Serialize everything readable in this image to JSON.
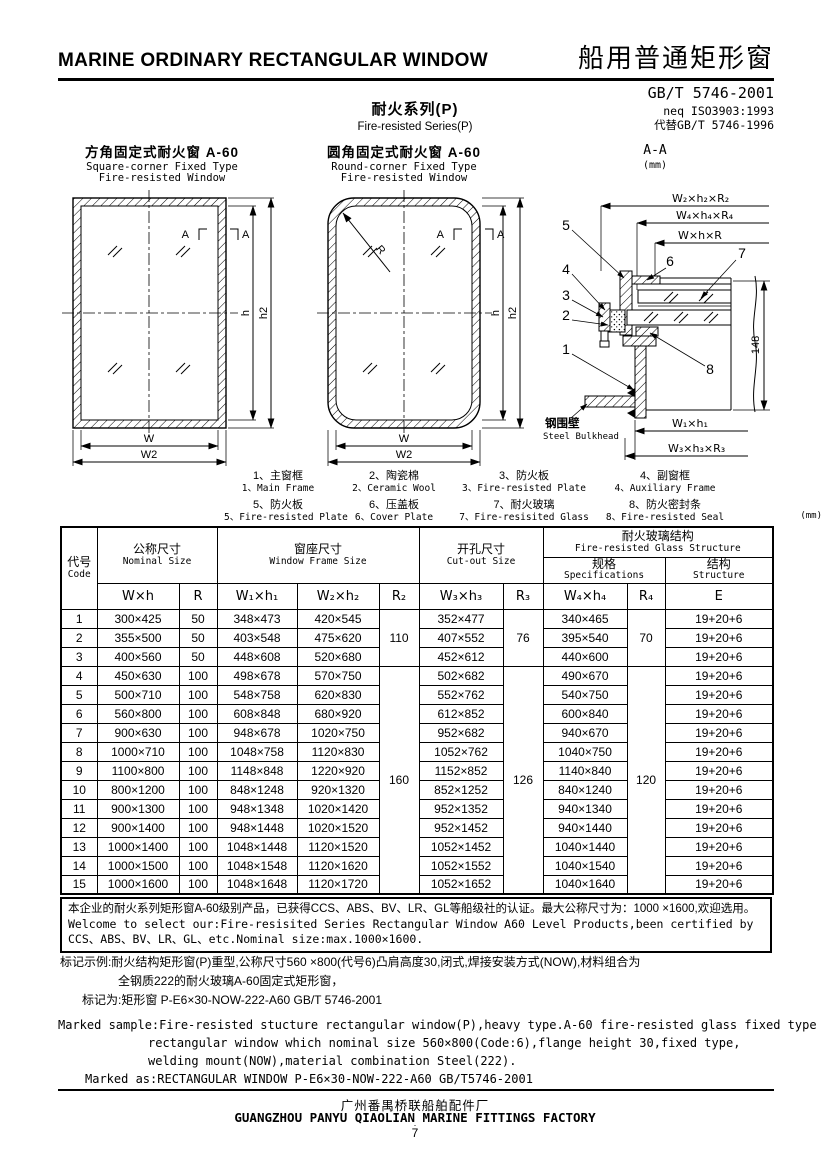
{
  "header": {
    "title_en": "MARINE ORDINARY RECTANGULAR WINDOW",
    "title_cn": "船用普通矩形窗",
    "standard": "GB/T 5746-2001",
    "standard_equiv": "neq ISO3903:1993",
    "standard_replaces": "代替GB/T 5746-1996",
    "series_cn": "耐火系列(P)",
    "series_en": "Fire-resisted Series(P)"
  },
  "diagrams": {
    "square": {
      "title_cn": "方角固定式耐火窗  A-60",
      "title_en1": "Square-corner Fixed Type",
      "title_en2": "Fire-resisted Window",
      "dim_w": "W",
      "dim_w2": "W2",
      "dim_h": "h",
      "dim_h2": "h2",
      "section_letter": "A"
    },
    "round": {
      "title_cn": "圆角固定式耐火窗  A-60",
      "title_en1": "Round-corner Fixed Type",
      "title_en2": "Fire-resisted Window",
      "dim_w": "W",
      "dim_w2": "W2",
      "dim_h": "h",
      "dim_h2": "h2",
      "section_letter": "A",
      "radius_label": "R"
    },
    "section": {
      "title": "A-A",
      "unit": "(mm)",
      "dim_w2h2r2": "W₂×h₂×R₂",
      "dim_w4h4r4": "W₄×h₄×R₄",
      "dim_whr": "W×h×R",
      "dim_w1h1": "W₁×h₁",
      "dim_w3h3r3": "W₃×h₃×R₃",
      "dim_148": "148",
      "bulkhead_cn": "钢围壁",
      "bulkhead_en": "Steel Bulkhead",
      "part_numbers": [
        "1",
        "2",
        "3",
        "4",
        "5",
        "6",
        "7",
        "8"
      ]
    }
  },
  "legend": {
    "items": [
      {
        "cn": "1、主窗框",
        "en": "1、Main Frame"
      },
      {
        "cn": "2、陶瓷棉",
        "en": "2、Ceramic Wool"
      },
      {
        "cn": "3、防火板",
        "en": "3、Fire-resisted Plate"
      },
      {
        "cn": "4、副窗框",
        "en": "4、Auxiliary Frame"
      },
      {
        "cn": "5、防火板",
        "en": "5、Fire-resisted Plate"
      },
      {
        "cn": "6、压盖板",
        "en": "6、Cover Plate"
      },
      {
        "cn": "7、耐火玻璃",
        "en": "7、Fire-resisited Glass"
      },
      {
        "cn": "8、防火密封条",
        "en": "8、Fire-resisted Seal"
      }
    ]
  },
  "table": {
    "unit_note": "(mm)",
    "header": {
      "code_cn": "代号",
      "code_en": "Code",
      "nominal_cn": "公称尺寸",
      "nominal_en": "Nominal Size",
      "frame_cn": "窗座尺寸",
      "frame_en": "Window Frame Size",
      "cutout_cn": "开孔尺寸",
      "cutout_en": "Cut-out Size",
      "glass_cn": "耐火玻璃结构",
      "glass_en": "Fire-resisted Glass Structure",
      "spec_cn": "规格",
      "spec_en": "Specifications",
      "struct_cn": "结构",
      "struct_en": "Structure",
      "col_wh": "W×h",
      "col_r": "R",
      "col_w1h1": "W₁×h₁",
      "col_w2h2": "W₂×h₂",
      "col_r2": "R₂",
      "col_w3h3": "W₃×h₃",
      "col_r3": "R₃",
      "col_w4h4": "W₄×h₄",
      "col_r4": "R₄",
      "col_e": "E"
    },
    "r2_groups": [
      "110",
      "160"
    ],
    "r3_groups": [
      "76",
      "126"
    ],
    "r4_groups": [
      "70",
      "120"
    ],
    "rows": [
      {
        "code": "1",
        "wh": "300×425",
        "r": "50",
        "w1h1": "348×473",
        "w2h2": "420×545",
        "w3h3": "352×477",
        "w4h4": "340×465",
        "e": "19+20+6"
      },
      {
        "code": "2",
        "wh": "355×500",
        "r": "50",
        "w1h1": "403×548",
        "w2h2": "475×620",
        "w3h3": "407×552",
        "w4h4": "395×540",
        "e": "19+20+6"
      },
      {
        "code": "3",
        "wh": "400×560",
        "r": "50",
        "w1h1": "448×608",
        "w2h2": "520×680",
        "w3h3": "452×612",
        "w4h4": "440×600",
        "e": "19+20+6"
      },
      {
        "code": "4",
        "wh": "450×630",
        "r": "100",
        "w1h1": "498×678",
        "w2h2": "570×750",
        "w3h3": "502×682",
        "w4h4": "490×670",
        "e": "19+20+6"
      },
      {
        "code": "5",
        "wh": "500×710",
        "r": "100",
        "w1h1": "548×758",
        "w2h2": "620×830",
        "w3h3": "552×762",
        "w4h4": "540×750",
        "e": "19+20+6"
      },
      {
        "code": "6",
        "wh": "560×800",
        "r": "100",
        "w1h1": "608×848",
        "w2h2": "680×920",
        "w3h3": "612×852",
        "w4h4": "600×840",
        "e": "19+20+6"
      },
      {
        "code": "7",
        "wh": "900×630",
        "r": "100",
        "w1h1": "948×678",
        "w2h2": "1020×750",
        "w3h3": "952×682",
        "w4h4": "940×670",
        "e": "19+20+6"
      },
      {
        "code": "8",
        "wh": "1000×710",
        "r": "100",
        "w1h1": "1048×758",
        "w2h2": "1120×830",
        "w3h3": "1052×762",
        "w4h4": "1040×750",
        "e": "19+20+6"
      },
      {
        "code": "9",
        "wh": "1100×800",
        "r": "100",
        "w1h1": "1148×848",
        "w2h2": "1220×920",
        "w3h3": "1152×852",
        "w4h4": "1140×840",
        "e": "19+20+6"
      },
      {
        "code": "10",
        "wh": "800×1200",
        "r": "100",
        "w1h1": "848×1248",
        "w2h2": "920×1320",
        "w3h3": "852×1252",
        "w4h4": "840×1240",
        "e": "19+20+6"
      },
      {
        "code": "11",
        "wh": "900×1300",
        "r": "100",
        "w1h1": "948×1348",
        "w2h2": "1020×1420",
        "w3h3": "952×1352",
        "w4h4": "940×1340",
        "e": "19+20+6"
      },
      {
        "code": "12",
        "wh": "900×1400",
        "r": "100",
        "w1h1": "948×1448",
        "w2h2": "1020×1520",
        "w3h3": "952×1452",
        "w4h4": "940×1440",
        "e": "19+20+6"
      },
      {
        "code": "13",
        "wh": "1000×1400",
        "r": "100",
        "w1h1": "1048×1448",
        "w2h2": "1120×1520",
        "w3h3": "1052×1452",
        "w4h4": "1040×1440",
        "e": "19+20+6"
      },
      {
        "code": "14",
        "wh": "1000×1500",
        "r": "100",
        "w1h1": "1048×1548",
        "w2h2": "1120×1620",
        "w3h3": "1052×1552",
        "w4h4": "1040×1540",
        "e": "19+20+6"
      },
      {
        "code": "15",
        "wh": "1000×1600",
        "r": "100",
        "w1h1": "1048×1648",
        "w2h2": "1120×1720",
        "w3h3": "1052×1652",
        "w4h4": "1040×1640",
        "e": "19+20+6"
      }
    ]
  },
  "notes": {
    "box_line1": "本企业的耐火系列矩形窗A-60级别产品，已获得CCS、ABS、BV、LR、GL等船级社的认证。最大公称尺寸为：1000 ×1600,欢迎选用。",
    "box_line2": "Welcome to select our:Fire-resisited Series Rectangular Window A60 Level Products,been certified by",
    "box_line3": "CCS、ABS、BV、LR、GL、etc.Nominal size:max.1000×1600."
  },
  "marking": {
    "cn_line1": "标记示例:耐火结构矩形窗(P)重型,公称尺寸560 ×800(代号6)凸肩高度30,闭式,焊接安装方式(NOW),材料组合为",
    "cn_line2": "全钢质222的耐火玻璃A-60固定式矩形窗，",
    "cn_line3": "标记为:矩形窗  P-E6×30-NOW-222-A60  GB/T 5746-2001",
    "en_line1": "Marked sample:Fire-resisted stucture rectangular window(P),heavy type.A-60 fire-resisted glass fixed type",
    "en_line2": "rectangular window which nominal size 560×800(Code:6),flange height 30,fixed type,",
    "en_line3": "welding mount(NOW),material combination Steel(222).",
    "en_line4": "Marked as:RECTANGULAR WINDOW  P-E6×30-NOW-222-A60  GB/T5746-2001"
  },
  "footer": {
    "factory_cn": "广州番禺桥联船舶配件厂",
    "factory_en": "GUANGZHOU PANYU QIAOLIAN MARINE FITTINGS FACTORY",
    "page_dot": "·",
    "page_number": "7"
  }
}
